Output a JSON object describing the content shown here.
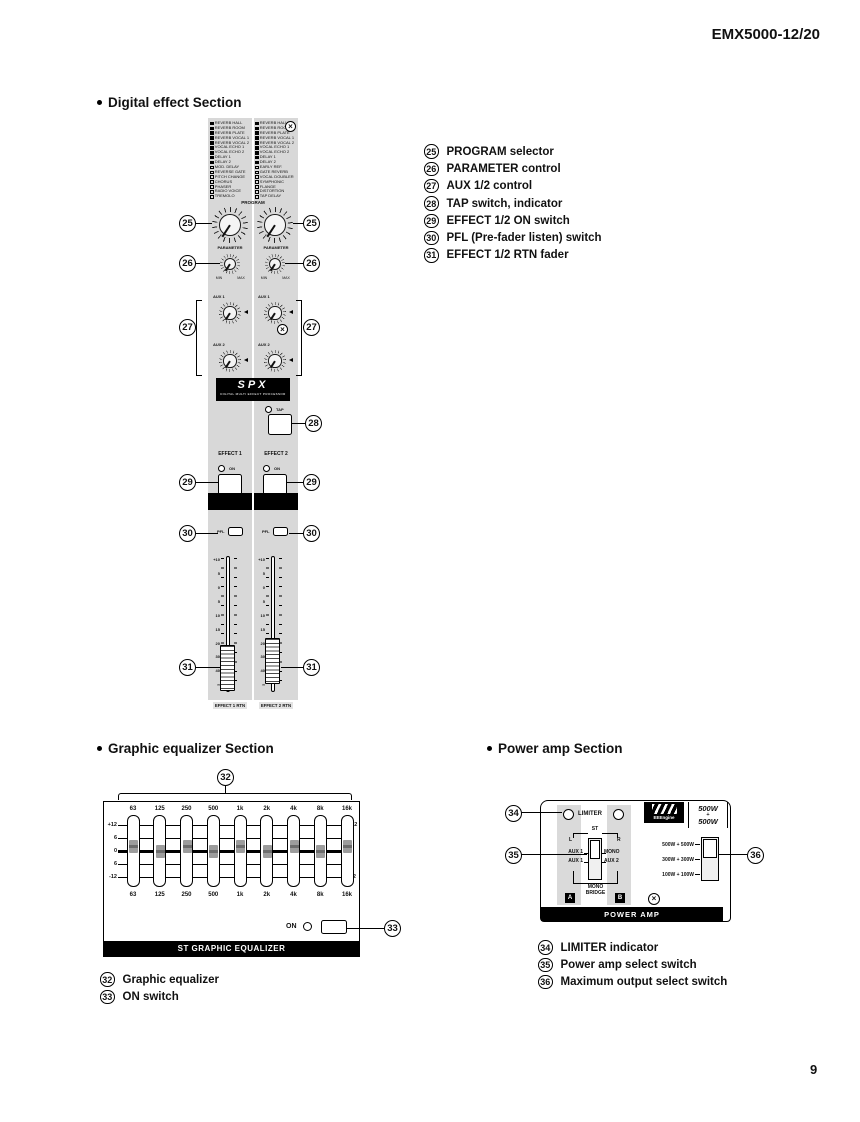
{
  "page": {
    "model": "EMX5000-12/20",
    "page_number": "9"
  },
  "symbols": {
    "cross": "×"
  },
  "digital_effect": {
    "heading": "Digital effect Section",
    "program_label": "PROGRAM",
    "parameter_label": "PARAMETER",
    "min_label": "MIN",
    "max_label": "MAX",
    "aux1_label": "AUX 1",
    "aux2_label": "AUX 2",
    "spx_logo": "SPX",
    "spx_sub": "DIGITAL MULTI EFFECT PROCESSOR",
    "tap_label": "TAP",
    "effect1_label": "EFFECT 1",
    "effect2_label": "EFFECT 2",
    "on_label": "ON",
    "pfl_label": "PFL",
    "effect1_rtn_label": "EFFECT 1 RTN",
    "effect2_rtn_label": "EFFECT 2 RTN",
    "fader_scale": [
      "+10",
      "5",
      "0",
      "5",
      "10",
      "15",
      "20",
      "30",
      "40",
      "∞"
    ],
    "programs_left": [
      "REVERB HALL",
      "REVERB ROOM",
      "REVERB PLATE",
      "REVERB VOCAL 1",
      "REVERB VOCAL 2",
      "VOCAL ECHO 1",
      "VOCAL ECHO 2",
      "DELAY 1",
      "DELAY 2",
      "MOD. DELAY",
      "REVERSE GATE",
      "PITCH CHANGE",
      "CHORUS",
      "PHASER",
      "RADIO VOICE",
      "TREMOLO"
    ],
    "programs_right": [
      "REVERB HALL",
      "REVERB ROOM",
      "REVERB PLATE",
      "REVERB VOCAL 1",
      "REVERB VOCAL 2",
      "VOCAL ECHO 1",
      "VOCAL ECHO 2",
      "DELAY 1",
      "DELAY 2",
      "EARLY REF.",
      "GATE REVERB",
      "VOCAL DOUBLER",
      "SYMPHONIC",
      "FLANGE",
      "DISTORTION",
      "TAP DELAY"
    ],
    "callouts": [
      {
        "num": "25",
        "label": "PROGRAM selector"
      },
      {
        "num": "26",
        "label": "PARAMETER control"
      },
      {
        "num": "27",
        "label": "AUX 1/2 control"
      },
      {
        "num": "28",
        "label": "TAP switch, indicator"
      },
      {
        "num": "29",
        "label": "EFFECT 1/2 ON switch"
      },
      {
        "num": "30",
        "label": "PFL (Pre-fader listen) switch"
      },
      {
        "num": "31",
        "label": "EFFECT 1/2 RTN fader"
      }
    ]
  },
  "graphic_eq": {
    "heading": "Graphic equalizer Section",
    "frequencies": [
      "63",
      "125",
      "250",
      "500",
      "1k",
      "2k",
      "4k",
      "8k",
      "16k"
    ],
    "scale_labels": [
      "+12",
      "6",
      "0",
      "6",
      "-12"
    ],
    "on_label": "ON",
    "bar_label": "ST GRAPHIC EQUALIZER",
    "callouts": [
      {
        "num": "32",
        "label": "Graphic equalizer"
      },
      {
        "num": "33",
        "label": "ON switch"
      }
    ]
  },
  "power_amp": {
    "heading": "Power amp Section",
    "limiter_label": "LIMITER",
    "logo_text": "EEEngine",
    "rating": [
      "500W",
      "+",
      "500W"
    ],
    "st_label": "ST",
    "l_label": "L",
    "r_label": "R",
    "aux_left_1": "AUX 1",
    "aux_left_2": "AUX 1",
    "mono_label": "MONO",
    "aux2_label": "AUX 2",
    "bridge_lines": [
      "MONO",
      "BRIDGE"
    ],
    "output_options": [
      "500W + 500W",
      "300W + 300W",
      "100W + 100W"
    ],
    "a_label": "A",
    "b_label": "B",
    "bar_label": "POWER AMP",
    "callouts": [
      {
        "num": "34",
        "label": "LIMITER indicator"
      },
      {
        "num": "35",
        "label": "Power amp select switch"
      },
      {
        "num": "36",
        "label": "Maximum output select switch"
      }
    ]
  }
}
